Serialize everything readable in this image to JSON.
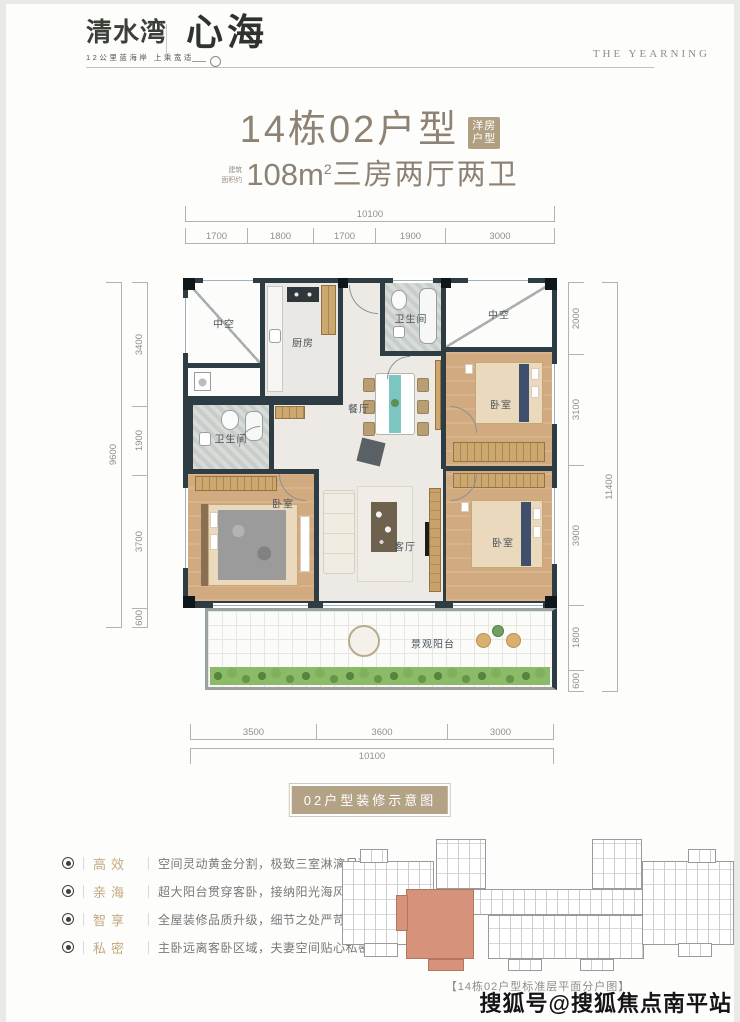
{
  "header": {
    "brand_primary": "清水湾",
    "brand_tagline": "12公里蓝海岸 上乘宽适",
    "brand_secondary": "心海",
    "brand_english": "THE YEARNING"
  },
  "title": {
    "main": "14栋02户型",
    "badge_line1": "洋房",
    "badge_line2": "户型",
    "area_prefix_line1": "建筑",
    "area_prefix_line2": "面积约",
    "area_number": "108m",
    "area_sup": "2",
    "area_text": "三房两厅两卫"
  },
  "floorplan": {
    "tag": "02户型装修示意图",
    "dims": {
      "top_total": "10100",
      "top": [
        "1700",
        "1800",
        "1700",
        "1900",
        "3000"
      ],
      "left_total": "9600",
      "left": [
        "3400",
        "1900",
        "3700",
        "600"
      ],
      "right_total": "11400",
      "right": [
        "2000",
        "3100",
        "3900",
        "1800",
        "600"
      ],
      "bottom": [
        "3500",
        "3600",
        "3000"
      ],
      "bottom_total": "10100"
    },
    "rooms": {
      "void_left": "中空",
      "kitchen": "厨房",
      "bath_top": "卫生间",
      "void_right": "中空",
      "dining": "餐厅",
      "bedroom_top_right": "卧室",
      "bath_left": "卫生间",
      "bedroom_left": "卧室",
      "living": "客厅",
      "bedroom_bottom_right": "卧室",
      "balcony": "景观阳台"
    }
  },
  "features": [
    {
      "keyword": "高效",
      "text": "空间灵动黄金分割，极致三室淋漓尽致"
    },
    {
      "keyword": "亲海",
      "text": "超大阳台贯穿客卧，接纳阳光海风光临"
    },
    {
      "keyword": "智享",
      "text": "全屋装修品质升级，细节之处严苛入微"
    },
    {
      "keyword": "私密",
      "text": "主卧远离客卧区域，夫妻空间贴心私密"
    }
  ],
  "keyplan": {
    "caption": "【14栋02户型标准层平面分户图】"
  },
  "watermark": "搜狐号@搜狐焦点南平站",
  "colors": {
    "accent_tan": "#b3a285",
    "title_color": "#8d8273",
    "wall": "#2e3d43",
    "wood": "#d2aa7f",
    "highlight_salmon": "#d6927a"
  }
}
